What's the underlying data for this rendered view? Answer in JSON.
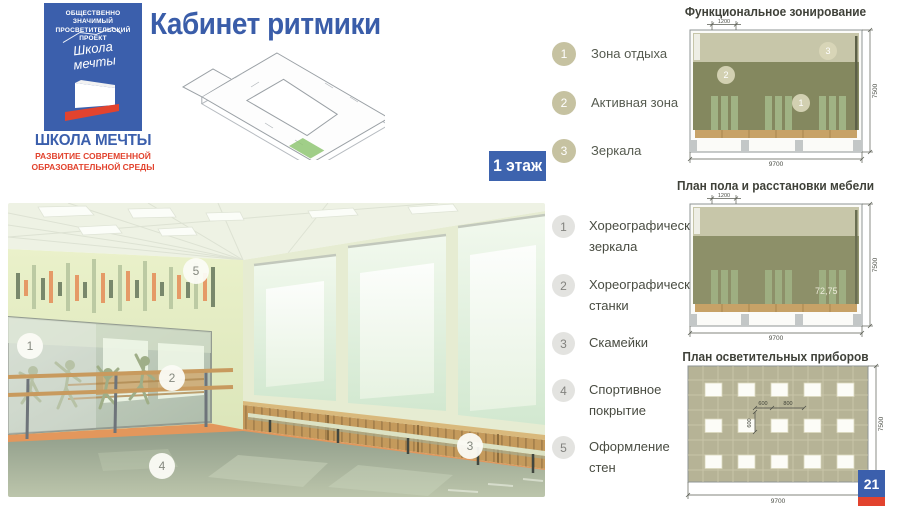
{
  "logo": {
    "project_label": "ОБЩЕСТВЕННО ЗНАЧИМЫЙ ПРОСВЕТИТЕЛЬСКИЙ ПРОЕКТ",
    "script_line1": "Школа",
    "script_line2": "мечты",
    "name": "ШКОЛА МЕЧТЫ",
    "subtitle": "РАЗВИТИЕ СОВРЕМЕННОЙ ОБРАЗОВАТЕЛЬНОЙ СРЕДЫ"
  },
  "header": {
    "title": "Кабинет ритмики",
    "floor_badge": "1 этаж"
  },
  "zones_legend": {
    "items": [
      {
        "num": "1",
        "label": "Зона отдыха"
      },
      {
        "num": "2",
        "label": "Активная зона"
      },
      {
        "num": "3",
        "label": "Зеркала"
      }
    ]
  },
  "features_legend": {
    "items": [
      {
        "num": "1",
        "label": "Хореографические зеркала"
      },
      {
        "num": "2",
        "label": "Хореографические станки"
      },
      {
        "num": "3",
        "label": "Скамейки"
      },
      {
        "num": "4",
        "label": "Спортивное покрытие"
      },
      {
        "num": "5",
        "label": "Оформление стен"
      }
    ]
  },
  "photo": {
    "markers": [
      "1",
      "2",
      "3",
      "4",
      "5"
    ]
  },
  "diagrams": [
    {
      "title": "Функциональное зонирование",
      "dim_top": "1200",
      "dim_bottom": "9700",
      "dim_right": "7500",
      "markers": [
        "1",
        "2",
        "3"
      ]
    },
    {
      "title": "План пола и расстановки мебели",
      "dim_top": "1200",
      "dim_bottom": "9700",
      "dim_right": "7500",
      "area_label": "72,75"
    },
    {
      "title": "План осветительных приборов",
      "dim_w1": "600",
      "dim_w2": "800",
      "dim_h1": "600",
      "dim_bottom": "9700",
      "dim_right": "7500"
    }
  ],
  "page_number": "21",
  "colors": {
    "brand_blue": "#3b5fac",
    "brand_red": "#e2432e",
    "zone_beige": "#c6c2a1",
    "plan_olive": "#84885f",
    "accent_orange": "#e59a67",
    "wall_green": "#e2eabf"
  }
}
